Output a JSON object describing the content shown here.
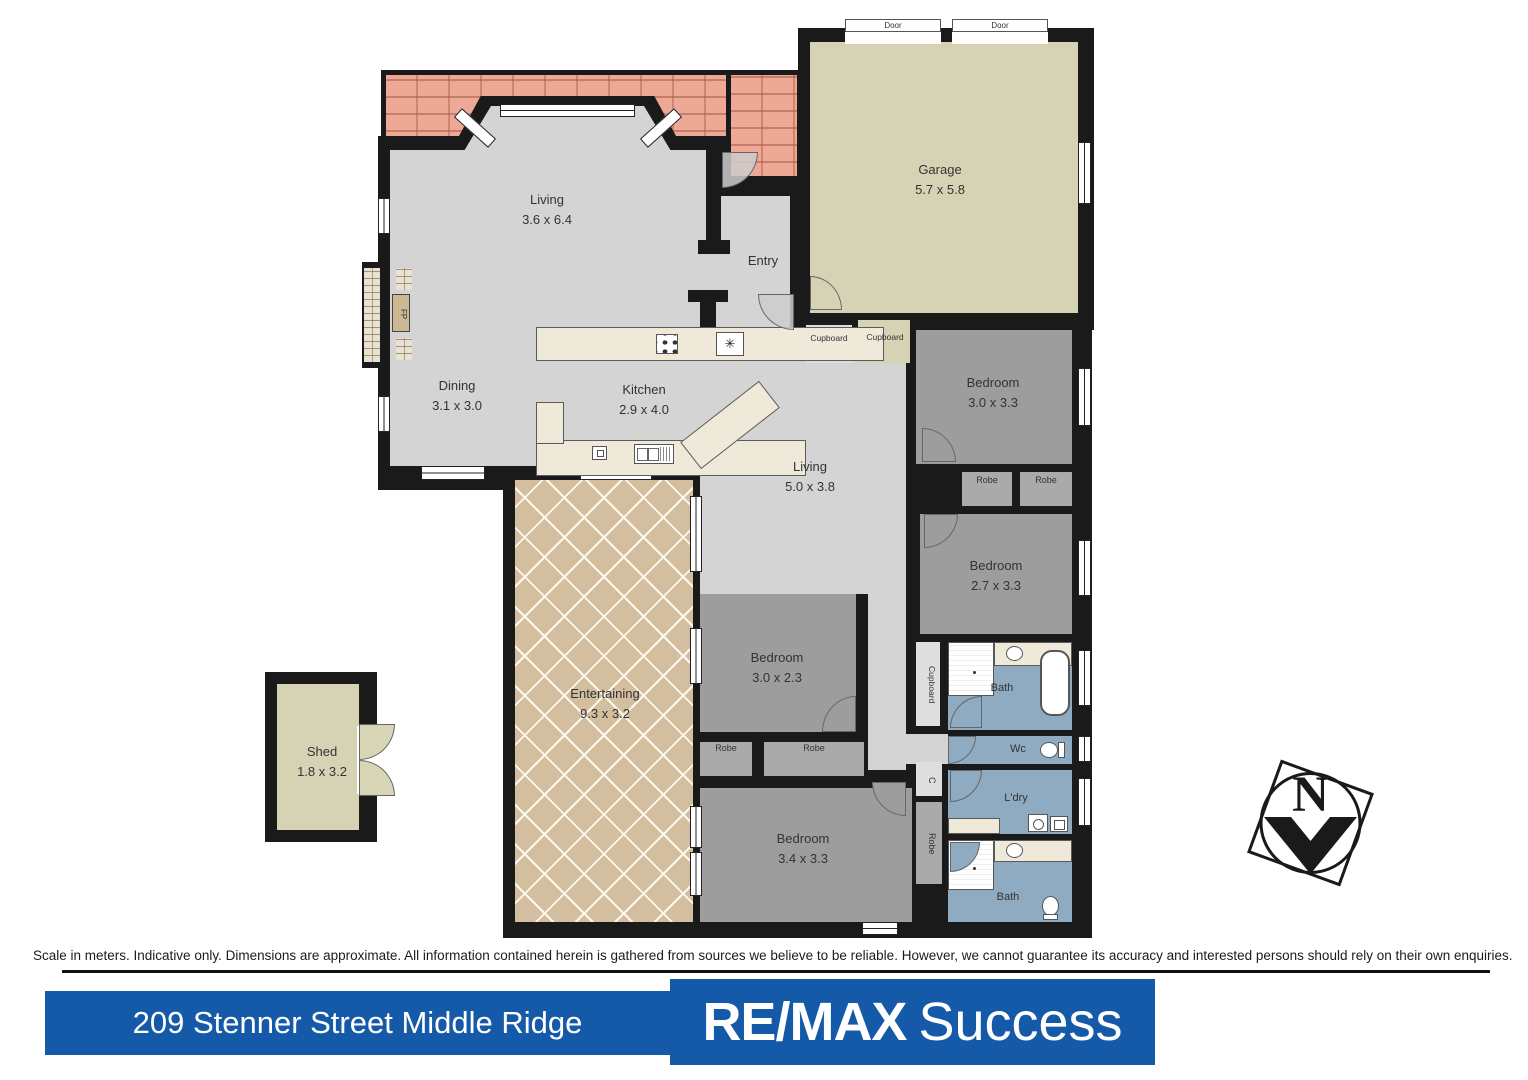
{
  "colors": {
    "accent_blue": "#155aa8",
    "wall": "#1a1a1a",
    "brick": "#eda896",
    "bath_blue": "#8fabc2"
  },
  "north_label": "N",
  "rooms": {
    "living_top": {
      "name": "Living",
      "dims": "3.6 x 6.4"
    },
    "entry": {
      "name": "Entry",
      "dims": ""
    },
    "garage": {
      "name": "Garage",
      "dims": "5.7 x 5.8"
    },
    "dining": {
      "name": "Dining",
      "dims": "3.1 x 3.0"
    },
    "kitchen": {
      "name": "Kitchen",
      "dims": "2.9 x 4.0"
    },
    "living_mid": {
      "name": "Living",
      "dims": "5.0 x 3.8"
    },
    "bed1": {
      "name": "Bedroom",
      "dims": "3.0 x 3.3"
    },
    "bed2": {
      "name": "Bedroom",
      "dims": "2.7 x 3.3"
    },
    "bed3": {
      "name": "Bedroom",
      "dims": "3.0 x 2.3"
    },
    "bed4": {
      "name": "Bedroom",
      "dims": "3.4 x 3.3"
    },
    "bath1": {
      "name": "Bath",
      "dims": ""
    },
    "wc": {
      "name": "Wc",
      "dims": ""
    },
    "ldry": {
      "name": "L'dry",
      "dims": ""
    },
    "bath2": {
      "name": "Bath",
      "dims": ""
    },
    "entertaining": {
      "name": "Entertaining",
      "dims": "9.3 x 3.2"
    },
    "shed": {
      "name": "Shed",
      "dims": "1.8 x 3.2"
    }
  },
  "labels": {
    "door": "Door",
    "cupboard": "Cupboard",
    "robe": "Robe",
    "c": "C",
    "fp": "FP"
  },
  "footer": {
    "disclaimer": "Scale in meters. Indicative only. Dimensions are approximate. All information contained herein is gathered from sources we believe to be reliable. However, we cannot guarantee its accuracy and interested persons should rely on their own enquiries.",
    "address": "209 Stenner Street Middle Ridge",
    "brand": "RE/MAX",
    "brand_suffix": "Success"
  }
}
